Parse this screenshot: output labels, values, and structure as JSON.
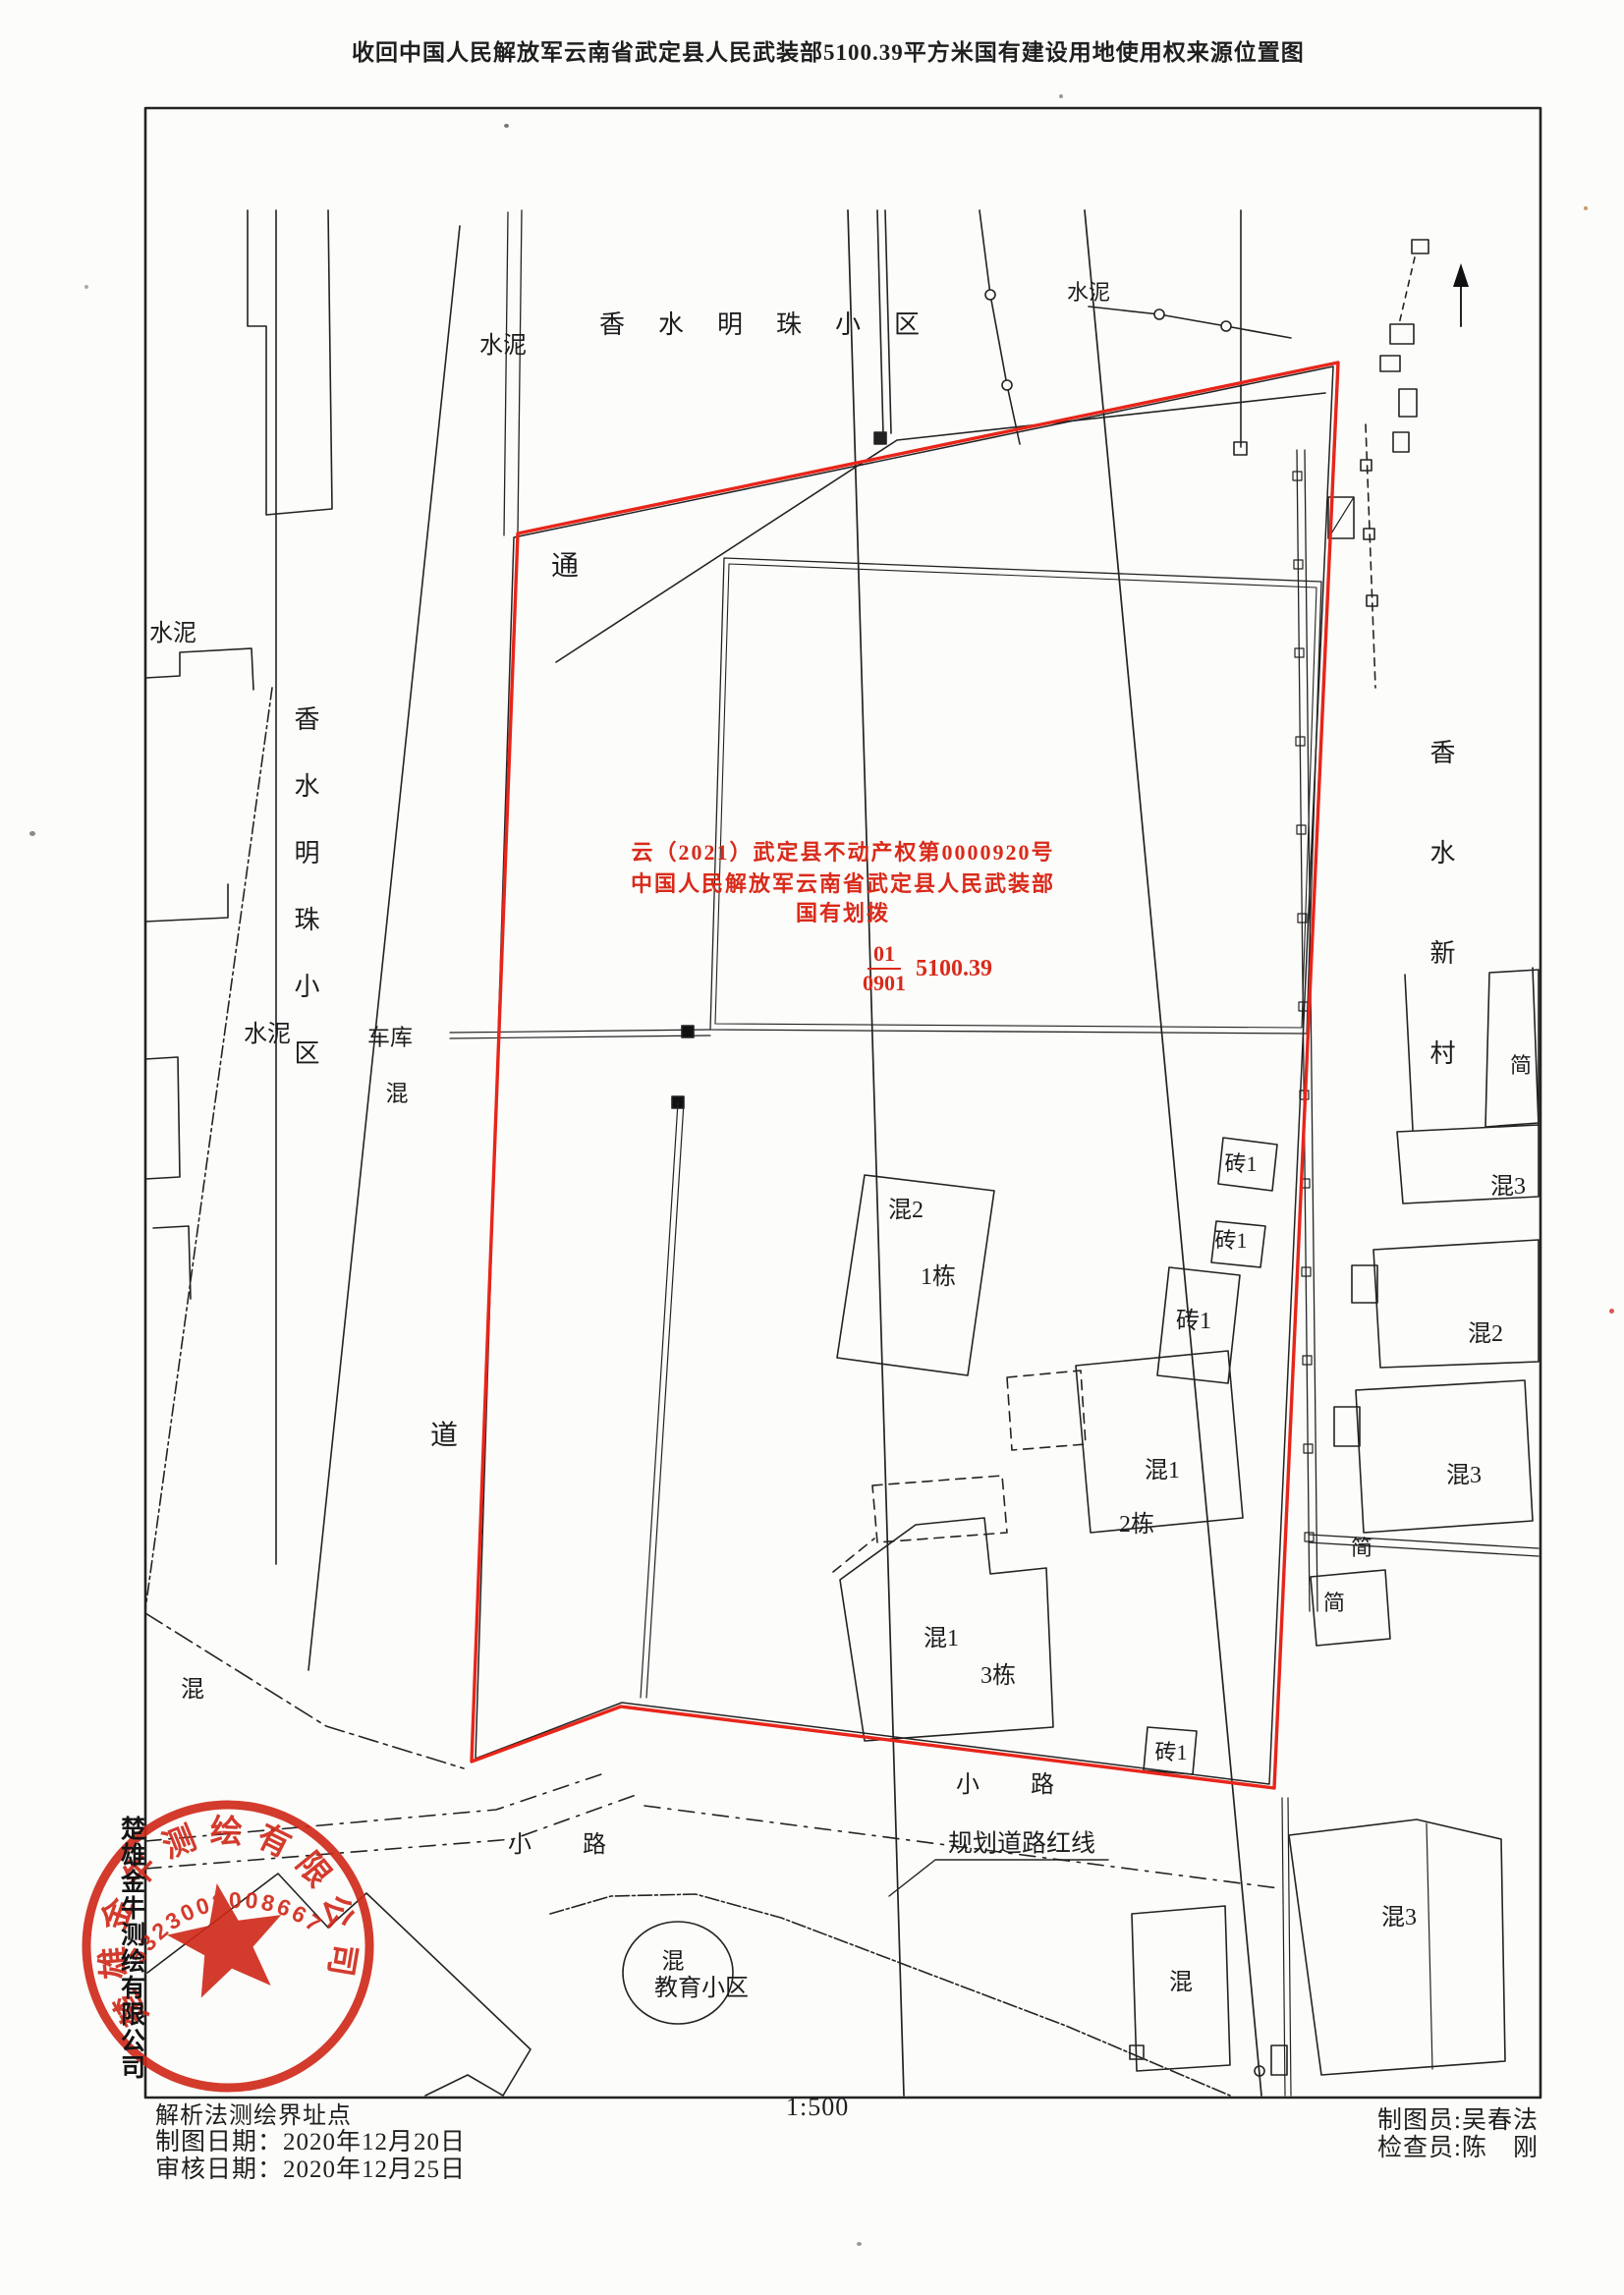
{
  "title": "收回中国人民解放军云南省武定县人民武装部5100.39平方米国有建设用地使用权来源位置图",
  "cert": {
    "line1": "云（2021）武定县不动产权第0000920号",
    "line2": "中国人民解放军云南省武定县人民武装部",
    "line3": "国有划拨",
    "parcel_no": "01",
    "land_code": "0901",
    "area": "5100.39"
  },
  "labels": {
    "cement_tl": "水泥",
    "estate_top": "香水明珠小区",
    "cement_tr": "水泥",
    "cement_l": "水泥",
    "estate_left": "香水明珠小区",
    "cement_l2": "水泥",
    "garage": "车库",
    "hun_road": "混",
    "tong": "通",
    "dao": "道",
    "hun_bl": "混",
    "b1_type": "混2",
    "b1_name": "1栋",
    "brick_a": "砖1",
    "brick_b": "砖1",
    "brick_c": "砖1",
    "b2_type": "混1",
    "b2_name": "2栋",
    "b3_type": "混1",
    "b3_name": "3栋",
    "brick_d": "砖1",
    "path1": "小　路",
    "path2": "小　路",
    "planning": "规划道路红线",
    "edu_hun": "混",
    "edu": "教育小区",
    "village_right": "香水新村",
    "jian1": "简",
    "r_hun3a": "混3",
    "r_hun2": "混2",
    "r_hun3b": "混3",
    "jian2": "简",
    "jian3": "简",
    "br_hun3": "混3",
    "br_hun": "混"
  },
  "footer": {
    "note": "解析法测绘界址点",
    "made": "制图日期：2020年12月20日",
    "checked": "审核日期：2020年12月25日",
    "scale": "1:500",
    "drafter": "制图员:吴春法",
    "inspector": "检查员:陈　刚"
  },
  "stamp": {
    "ring_text": "楚雄金牛测绘有限公司",
    "number": "5323002008667",
    "side_text": "楚雄金牛测绘有限公司"
  },
  "colors": {
    "boundary_red": "#e8251a",
    "stamp_red": "#cf2717",
    "ink": "#222222"
  }
}
